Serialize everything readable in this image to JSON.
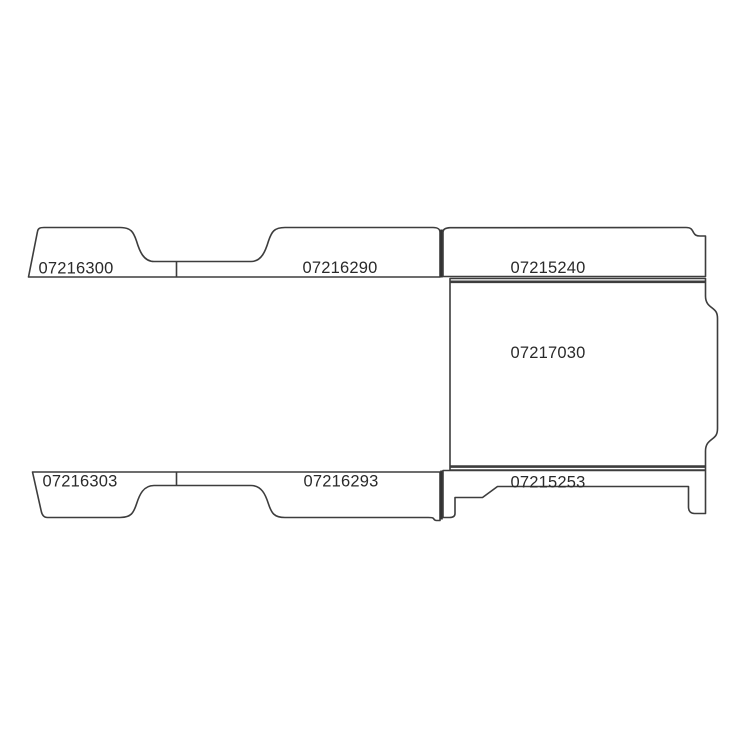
{
  "diagram": {
    "kind": "vehicle-floor-parts-line-drawing",
    "background": "#ffffff",
    "colors": {
      "line": "#3d3d3d",
      "divider": "#333333",
      "text": "#2a2a2a"
    },
    "labels": {
      "top_left": "07216300",
      "top_middle": "07216290",
      "top_right": "07215240",
      "center": "07217030",
      "bottom_left": "07216303",
      "bottom_middle": "07216293",
      "bottom_right": "07215253"
    }
  }
}
